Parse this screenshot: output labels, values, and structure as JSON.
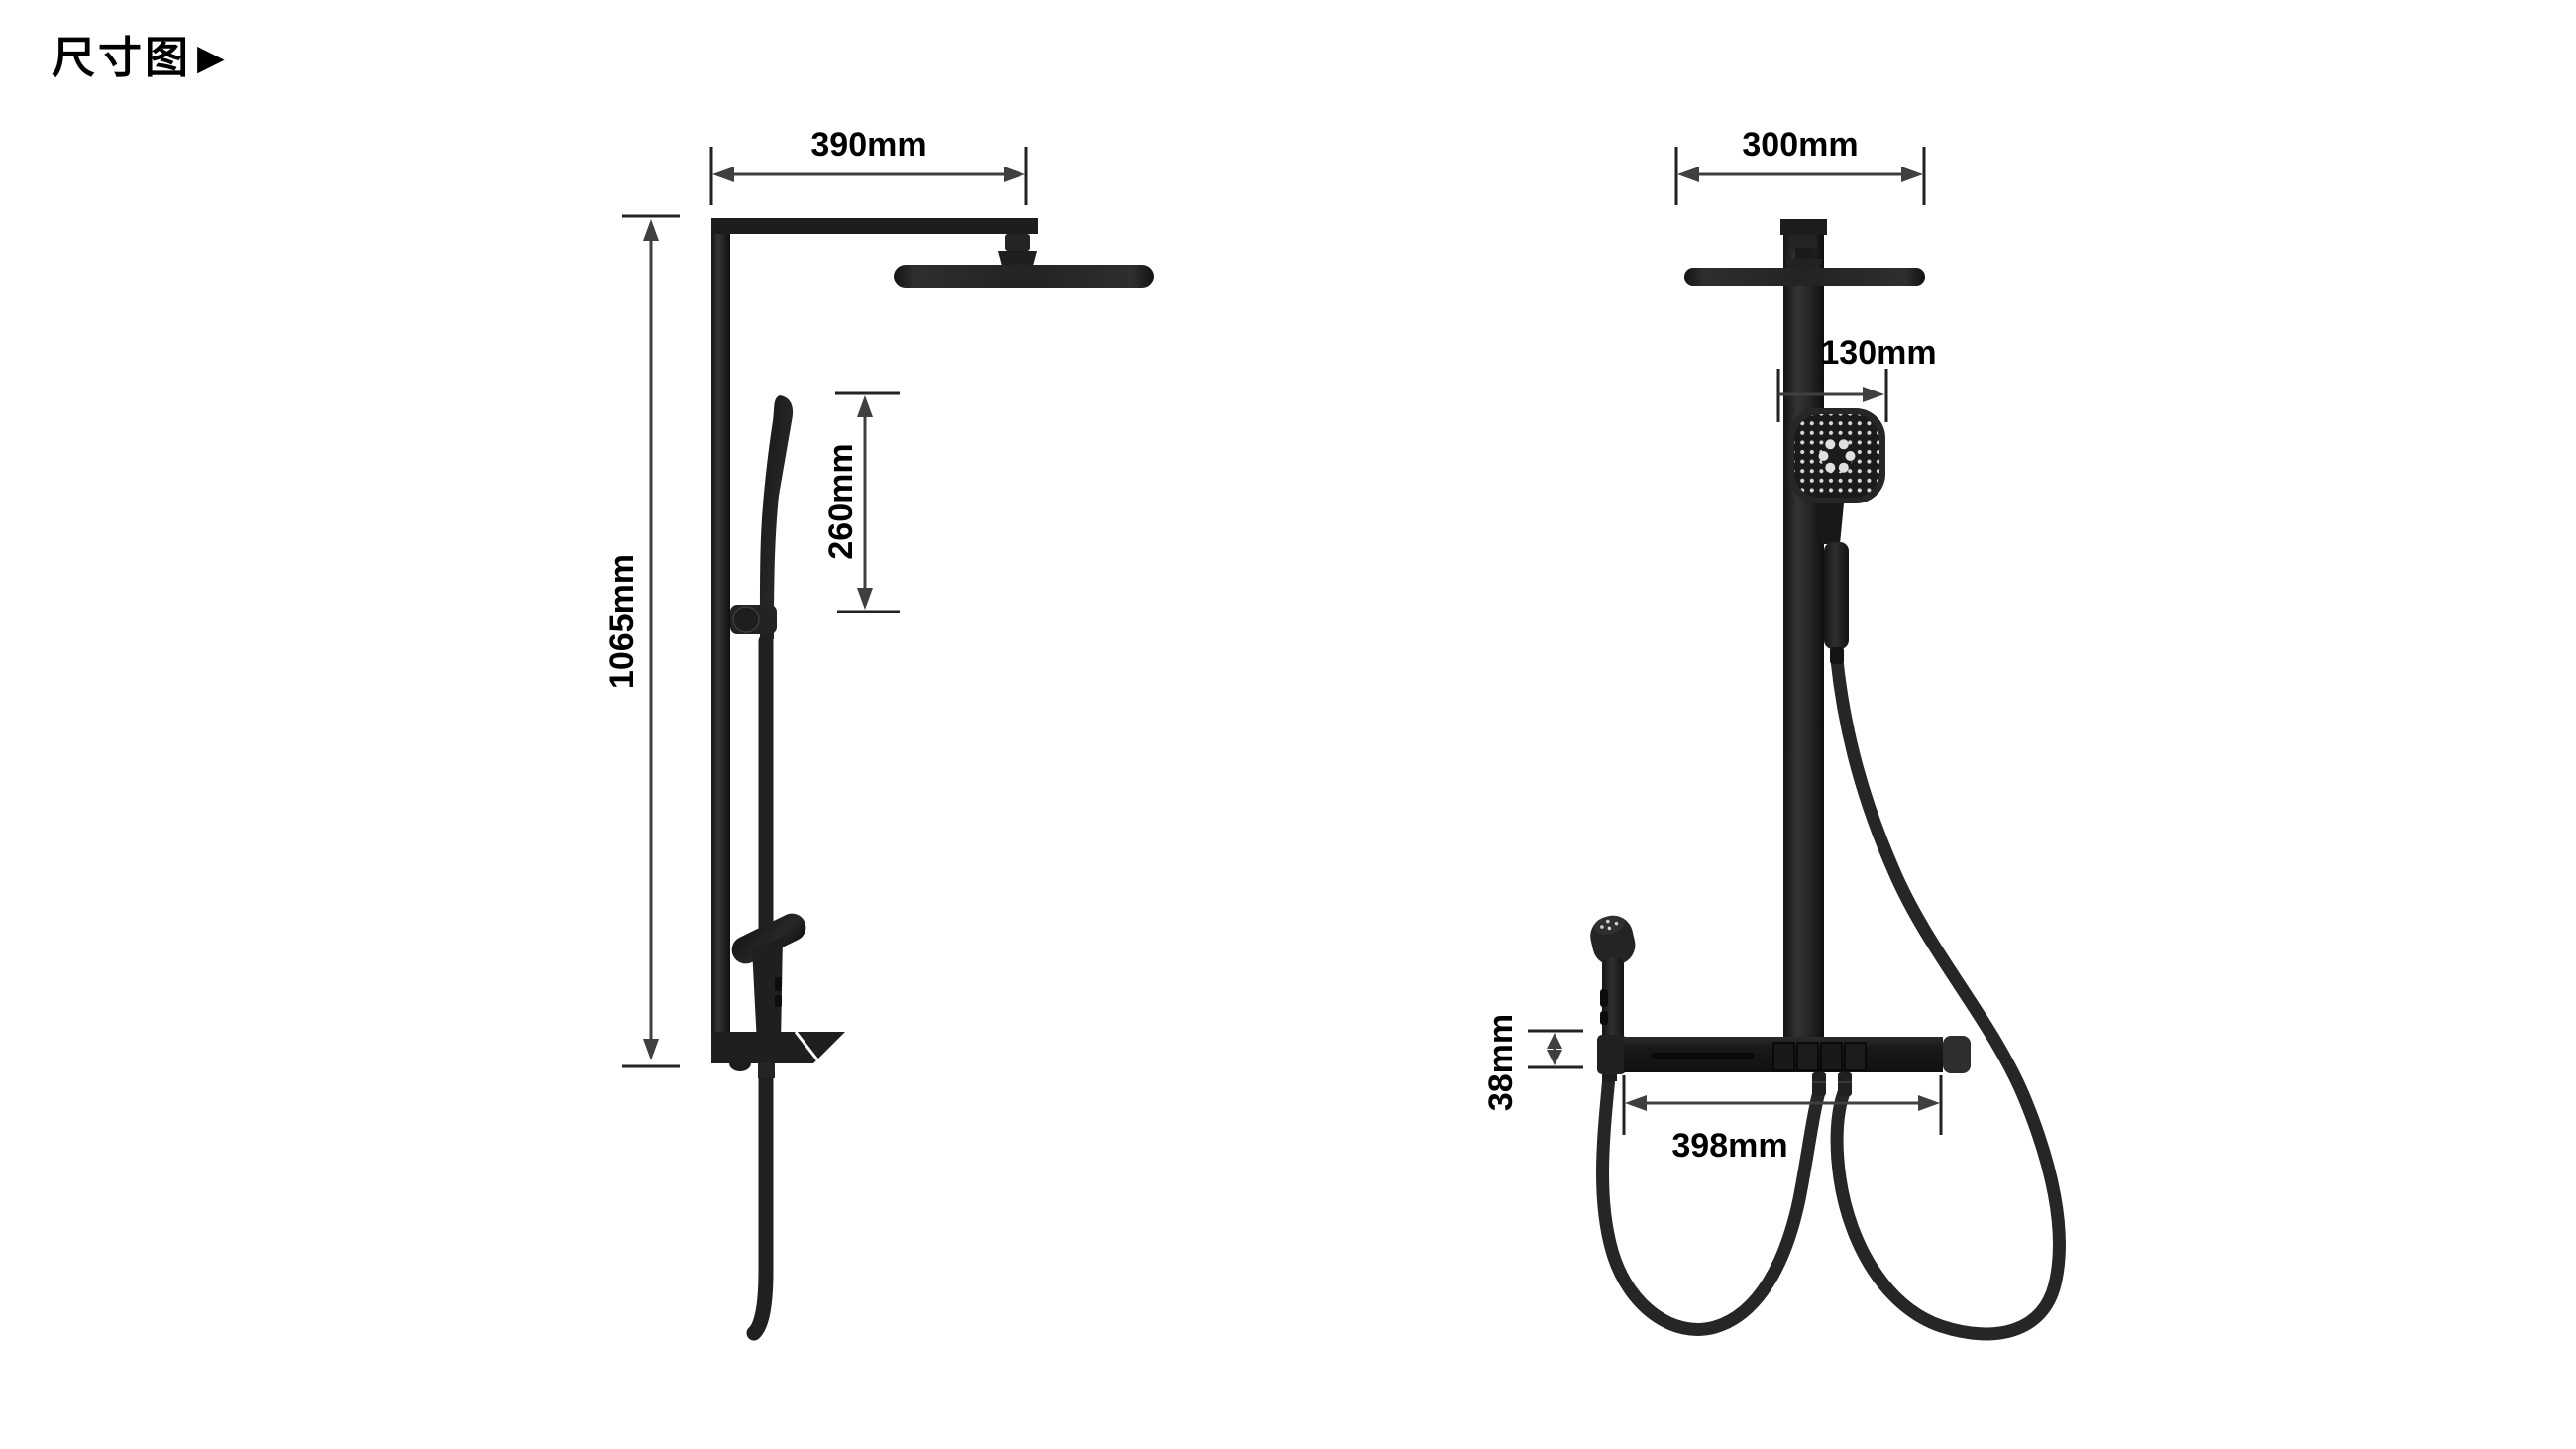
{
  "title": {
    "text": "尺寸图",
    "arrow_icon": "▶"
  },
  "colors": {
    "background": "#ffffff",
    "product": "#1f1f1f",
    "dimension_line": "#3f3f3f",
    "dimension_text": "#000000"
  },
  "dimensions": {
    "side_view": {
      "top_width": "390mm",
      "total_height": "1065mm",
      "hand_shower_length": "260mm"
    },
    "front_view": {
      "top_width": "300mm",
      "hand_shower_width": "130mm",
      "shelf_height": "38mm",
      "shelf_width": "398mm"
    }
  }
}
